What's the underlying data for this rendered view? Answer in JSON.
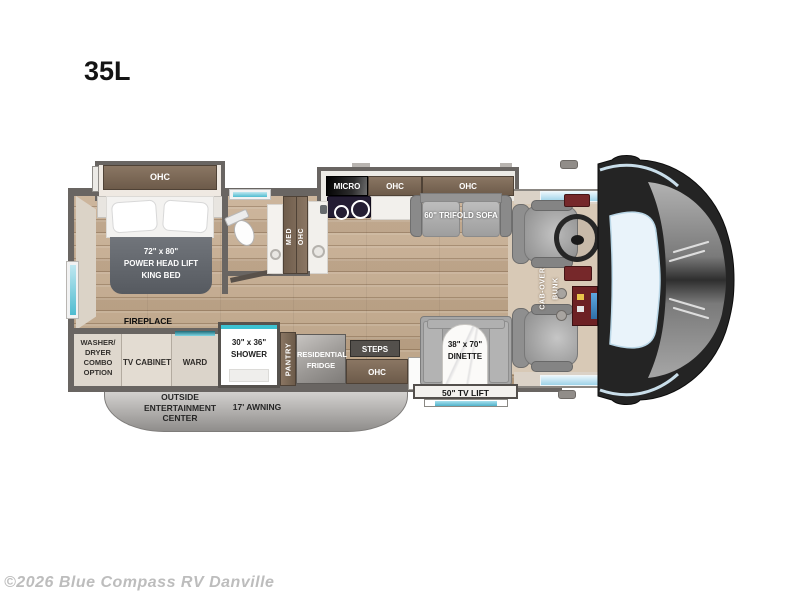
{
  "title": "35L",
  "watermark": "©2026 Blue Compass RV Danville",
  "bedroom": {
    "slide_ohc": "OHC",
    "bed_line1": "72\" x 80\"",
    "bed_line2": "POWER  HEAD LIFT",
    "bed_line3": "KING BED",
    "fireplace": "FIREPLACE"
  },
  "bathroom": {
    "med": "MED",
    "ohc": "OHC"
  },
  "kitchen": {
    "micro": "MICRO",
    "ohc_left": "OHC",
    "ohc_sofa": "OHC"
  },
  "living": {
    "sofa": "60\" TRIFOLD SOFA",
    "dinette_line1": "38\" x 70\"",
    "dinette_line2": "DINETTE",
    "tv_lift": "50\" TV LIFT"
  },
  "lower": {
    "washer_line1": "WASHER/",
    "washer_line2": "DRYER",
    "washer_line3": "COMBO",
    "washer_line4": "OPTION",
    "tv_cabinet": "TV CABINET",
    "ward": "WARD",
    "shower_line1": "30\" x 36\"",
    "shower_line2": "SHOWER",
    "pantry": "PANTRY",
    "fridge_line1": "RESIDENTIAL",
    "fridge_line2": "FRIDGE",
    "steps": "STEPS",
    "entry_ohc": "OHC"
  },
  "cab": {
    "bunk_line1": "CAB-OVER",
    "bunk_line2": "BUNK"
  },
  "exterior": {
    "outside_line1": "OUTSIDE",
    "outside_line2": "ENTERTAINMENT",
    "outside_line3": "CENTER",
    "awning": "17' AWNING"
  },
  "colors": {
    "wall": "#696562",
    "wood_floor": "#c6ae95",
    "cabinet_brown": "#7b6755",
    "furniture_gray": "#a6a6a6",
    "window_teal": "#4fbcd0",
    "windshield_blue": "#e9f3fa",
    "cap_dark": "#242424",
    "fireplace_glow": "#f0a53c"
  }
}
